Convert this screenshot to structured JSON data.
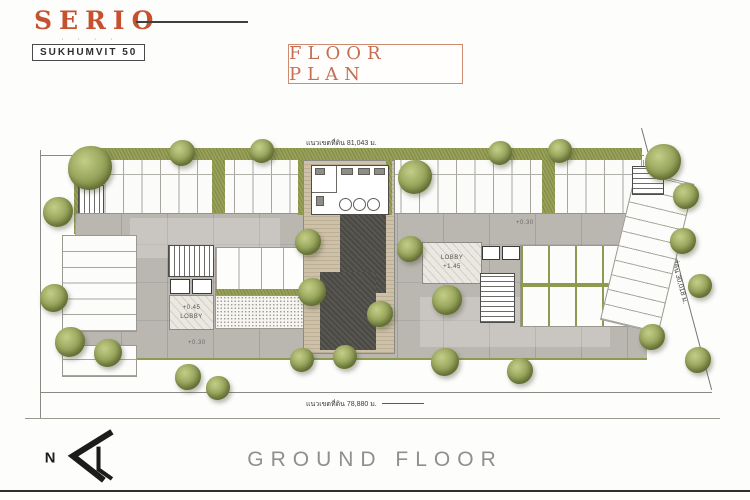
{
  "logo": {
    "title": "SERIO",
    "dots": "· · · ·",
    "subtitle": "SUKHUMVIT 50"
  },
  "header": {
    "title": "FLOOR PLAN"
  },
  "plan": {
    "dim_top": "แนวเขตที่ดิน 81,043 ม.",
    "dim_bottom": "แนวเขตที่ดิน 78,880 ม.",
    "dim_right": "แนวเขตที่ดิน 30,018 ม.",
    "lobby_left": {
      "level": "+0.45",
      "label": "LOBBY"
    },
    "lobby_right": {
      "label": "LOBBY",
      "level": "+1.45"
    },
    "level_upper": "+0.30",
    "level_lower": "+0.30"
  },
  "footer": {
    "caption": "GROUND FLOOR"
  },
  "compass": {
    "label": "N"
  },
  "colors": {
    "brand_orange": "#c6512f",
    "title_orange": "#c46f54",
    "tree_green": "#8e9a51",
    "planting_green": "#98a157",
    "deck_tan": "#cdc1a9",
    "courtyard_dark": "#595751",
    "paving_gray": "#bab7b1",
    "caption_gray": "#8f8f8f"
  }
}
